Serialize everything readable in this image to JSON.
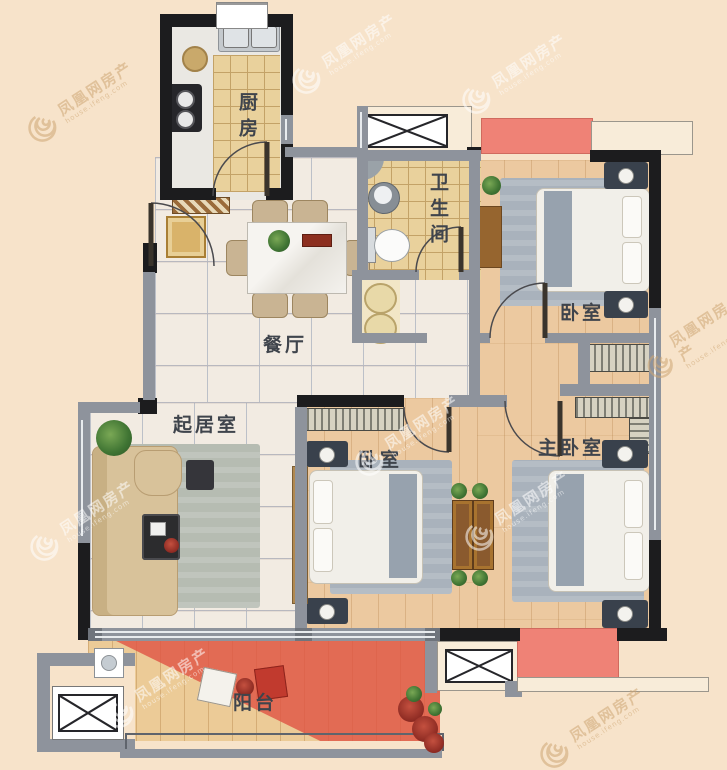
{
  "rooms": [
    {
      "id": "kitchen",
      "label": "厨房"
    },
    {
      "id": "dining",
      "label": "餐厅"
    },
    {
      "id": "bathroom",
      "label": "卫生间"
    },
    {
      "id": "bedroom-north",
      "label": "卧室"
    },
    {
      "id": "living",
      "label": "起居室"
    },
    {
      "id": "bedroom-middle",
      "label": "卧室"
    },
    {
      "id": "master-bedroom",
      "label": "主卧室"
    },
    {
      "id": "balcony",
      "label": "阳台"
    }
  ],
  "watermark": {
    "text": "凤凰网房产",
    "subtext": "house.ifeng.com"
  },
  "colors": {
    "background": "#f7e3ca",
    "wall_black": "#1c1c1e",
    "wall_gray": "#8e939c",
    "ac_platform_red": "#ef8276",
    "balcony_red": "#e05244",
    "label_text": "#3f444c"
  }
}
